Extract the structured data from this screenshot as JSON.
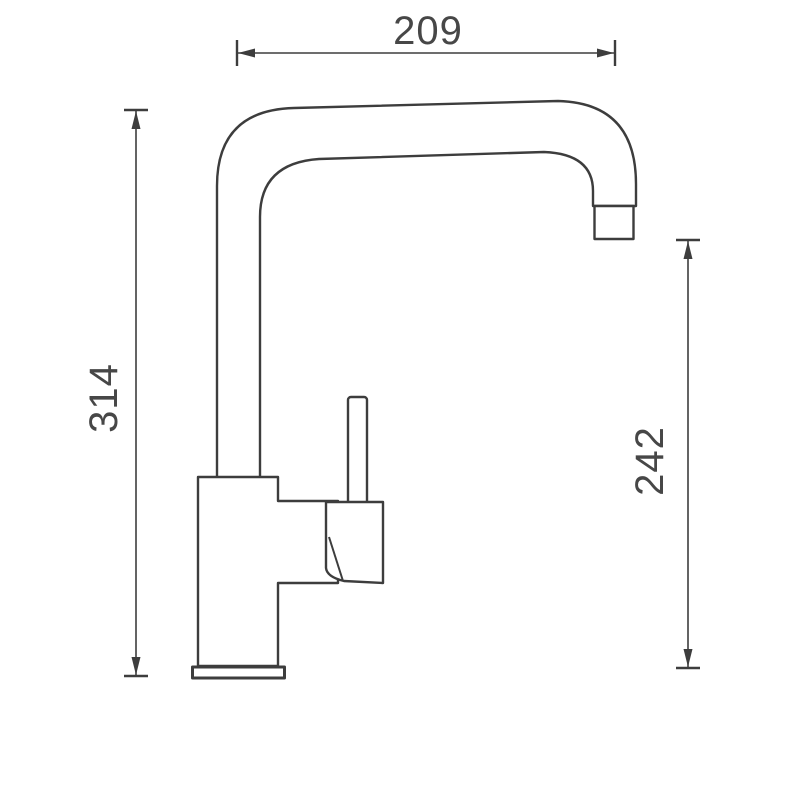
{
  "drawing": {
    "kind": "faucet-dimension-drawing",
    "colors": {
      "line": "#3d3d3d",
      "label": "#474747",
      "background": "#ffffff"
    },
    "dimensions": {
      "top_width": "209",
      "left_height": "314",
      "right_height": "242"
    }
  }
}
